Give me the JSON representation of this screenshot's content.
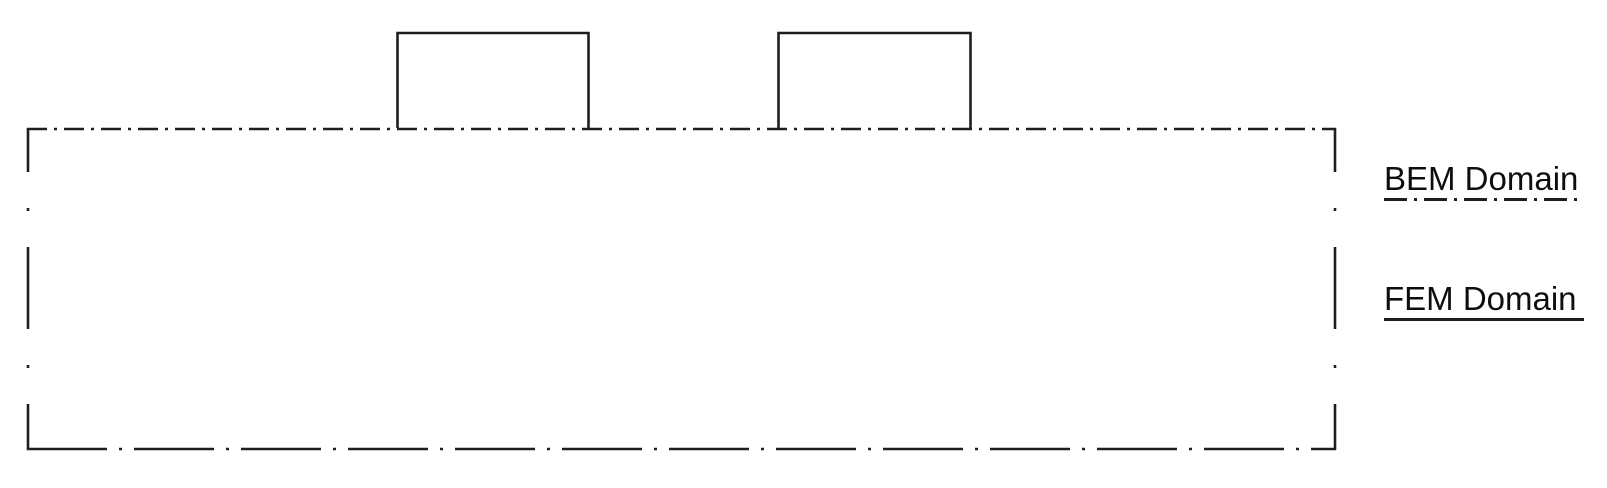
{
  "figure": {
    "type": "bem-fem-coupling-diagram",
    "labels": {
      "bem": "BEM Domain",
      "fem": "FEM Domain"
    },
    "legend": {
      "bem_line_style": "dash-dot",
      "fem_line_style": "solid"
    },
    "colors": {
      "line": "#1e1e1e",
      "text": "#0e0e0e",
      "background": "#ffffff"
    }
  }
}
